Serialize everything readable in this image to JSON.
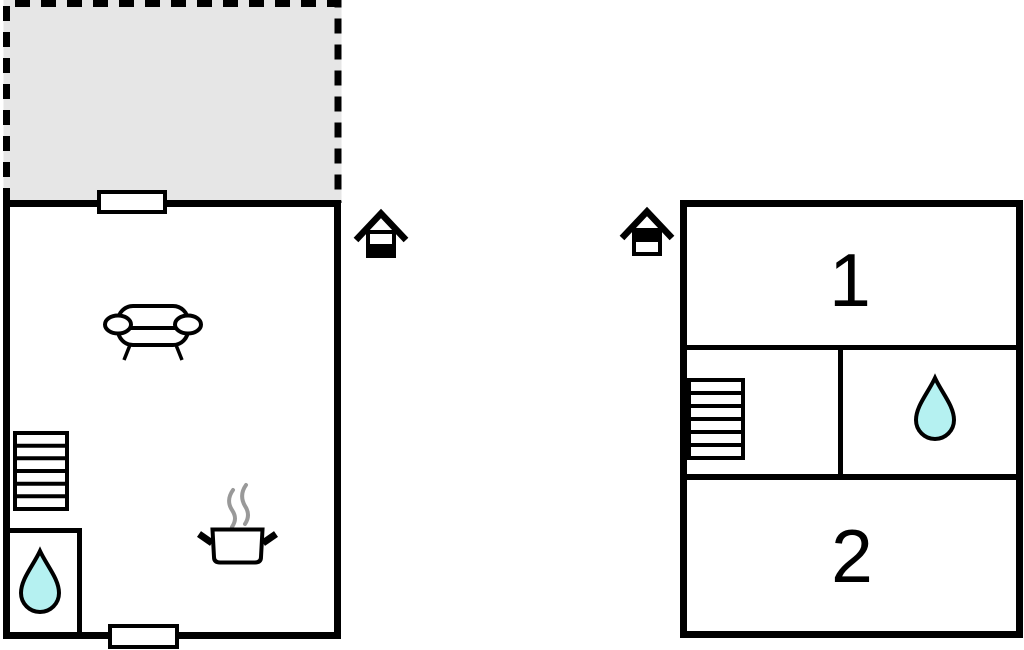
{
  "title": "floor-plan",
  "colors": {
    "background": "#ffffff",
    "wall": "#000000",
    "terrace_fill": "#e6e6e6",
    "water_fill": "#b5f1f1",
    "steam": "#999999"
  },
  "ground_floor": {
    "indicator_icon": "house-ground-floor-icon",
    "features": {
      "terrace": "terrace-dashed-area",
      "sofa": "sofa-icon",
      "stairs": "stairs-icon",
      "bathroom": "water-drop-icon",
      "kitchen": "cooking-pot-icon",
      "doorways": [
        "doorway-top",
        "doorway-bottom"
      ]
    }
  },
  "upper_floor": {
    "indicator_icon": "house-upper-floor-icon",
    "rooms": [
      {
        "label": "1"
      },
      {
        "label": "2"
      }
    ],
    "features": {
      "stairs": "stairs-icon",
      "bathroom": "water-drop-icon"
    }
  }
}
